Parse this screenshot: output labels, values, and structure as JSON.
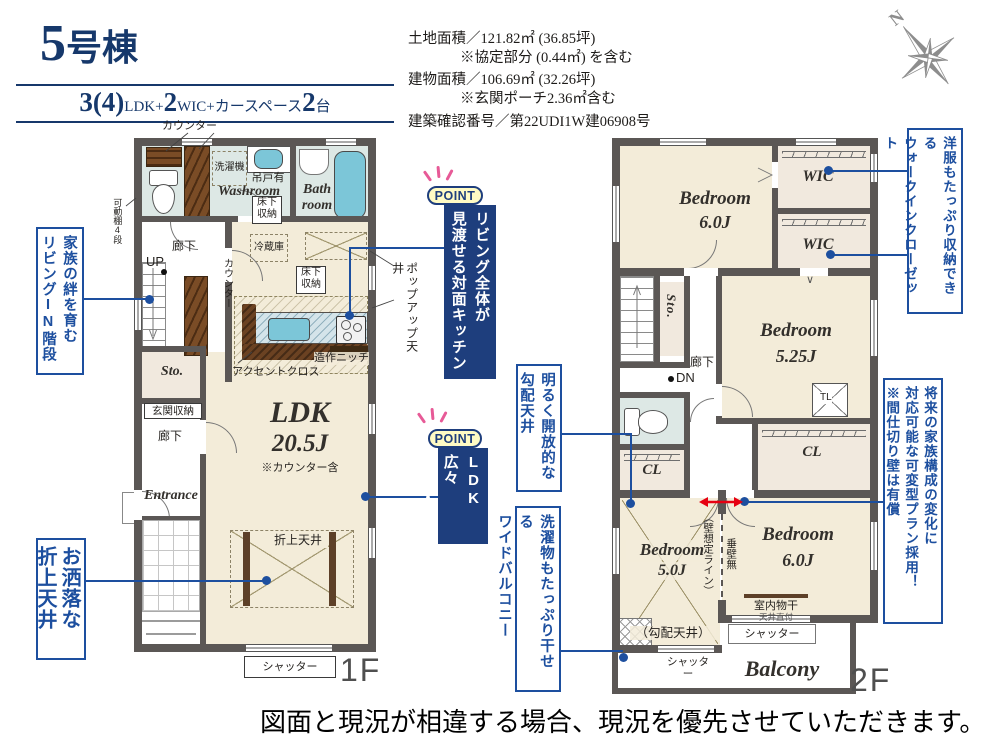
{
  "header": {
    "title_num": "5",
    "title_suffix": "号棟",
    "spec": {
      "b1": "3(4)",
      "s1": "LDK+",
      "b2": "2",
      "s2": "WIC+カースペース",
      "b3": "2",
      "s3": "台"
    }
  },
  "site_info": {
    "land": "土地面積／121.82㎡ (36.85坪)",
    "land_note": "※協定部分 (0.44㎡) を含む",
    "building": "建物面積／106.69㎡ (32.26坪)",
    "building_note": "※玄関ポーチ2.36㎡含む",
    "permit": "建築確認番号／第22UDI1W建06908号"
  },
  "compass": {
    "north": "N"
  },
  "f1": {
    "floor": "1F",
    "counter_top": "カウンター",
    "movable_shelf": "可動棚4段",
    "laundry": "洗濯機",
    "hanging_cabinet": "吊戸有",
    "washroom": "Washroom",
    "underfloor_a1": "床下",
    "underfloor_a2": "収納",
    "bath1": "Bath",
    "bath2": "room",
    "hall1": "廊下",
    "up": "UP",
    "fridge": "冷蔵庫",
    "counter_kitchen": "カウンター",
    "popup_ceiling": "ポップアップ天井",
    "underfloor_b1": "床下",
    "underfloor_b2": "収納",
    "niche": "造作ニッチ",
    "accent_cloth": "アクセントクロス",
    "sto": "Sto.",
    "genkan_storage": "玄関収納",
    "hall2": "廊下",
    "entrance": "Entrance",
    "ldk": "LDK",
    "ldk_size": "20.5J",
    "ldk_note": "※カウンター含",
    "folded_ceiling": "折上天井",
    "shutter": "シャッター"
  },
  "f2": {
    "floor": "2F",
    "bedroom1": "Bedroom",
    "bedroom1_size": "6.0J",
    "wic1": "WIC",
    "wic2": "WIC",
    "wic_arrow": "∨",
    "sto": "Sto.",
    "hall": "廊下",
    "dn": "DN",
    "bedroom2": "Bedroom",
    "bedroom2_size": "5.25J",
    "tl": "TL",
    "cl1": "CL",
    "cl2": "CL",
    "bedroom3": "Bedroom",
    "bedroom3_size": "5.0J",
    "slope_note": "（勾配天井）",
    "wall_line": "（壁想定ライン）",
    "no_hanging_wall": "垂壁無",
    "bedroom4": "Bedroom",
    "bedroom4_size": "6.0J",
    "indoor_drying": "室内物干",
    "ceiling_mount": "天井直付",
    "shutter1": "シャッター",
    "shutter2": "シャッター",
    "balcony": "Balcony"
  },
  "annotations": {
    "stairs_line1": "家族の絆を育む",
    "stairs_line2": "リビングIN階段",
    "ceiling_line1": "お洒落な",
    "ceiling_line2": "折上天井",
    "point_badge": "POINT",
    "point1_line1": "リビング全体が",
    "point1_line2": "見渡せる対面キッチン",
    "point2_line1": "LDK広々",
    "point2_line2": "20・5帖！",
    "slope_line1": "明るく開放的な",
    "slope_line2": "勾配天井",
    "balcony_line1": "洗濯物もたっぷり干せる",
    "balcony_line2": "ワイドバルコニー",
    "wic_line1": "洋服もたっぷり収納できる",
    "wic_line2": "ウォークインクローゼット",
    "plan_line1": "将来の家族構成の変化に",
    "plan_line2": "対応可能な可変型プラン採用！",
    "plan_line3": "※間仕切り壁は有償"
  },
  "footer": {
    "disclaimer": "図面と現況が相違する場合、現況を優先させていただきます。"
  },
  "colors": {
    "annotation_blue": "#1d4f9f",
    "point_navy": "#1e3e7d",
    "badge_yellow": "#fffbc4",
    "accent_pink": "#e75a97",
    "arrow_red": "#e60012",
    "wall_gray": "#5b5755",
    "floor_beige": "#f3ecd9",
    "wet_floor": "#dde8e5",
    "closet_floor": "#f1e9de",
    "water_blue": "#7cc6d8"
  }
}
